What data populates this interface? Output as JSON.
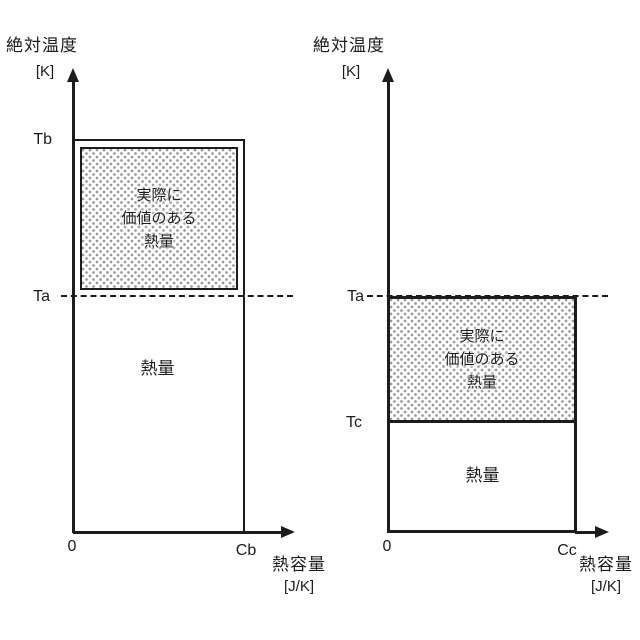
{
  "colors": {
    "line": "#1c1c1c",
    "stipple_dot": "#9a9a9a",
    "background": "#ffffff"
  },
  "panels": [
    {
      "name": "left",
      "y_axis_title": "絶対温度",
      "y_axis_unit": "[K]",
      "x_axis_title": "熱容量",
      "x_axis_unit": "[J/K]",
      "origin": "0",
      "x_max_label": "Cb",
      "y_top_label": "Tb",
      "y_dashed_label": "Ta",
      "valuable_heat": [
        "実際に",
        "価値のある",
        "熱量"
      ],
      "heat_label": "熱量"
    },
    {
      "name": "right",
      "y_axis_title": "絶対温度",
      "y_axis_unit": "[K]",
      "x_axis_title": "熱容量",
      "x_axis_unit": "[J/K]",
      "origin": "0",
      "x_max_label": "Cc",
      "y_dashed_label": "Ta",
      "y_mid_label": "Tc",
      "valuable_heat": [
        "実際に",
        "価値のある",
        "熱量"
      ],
      "heat_label": "熱量"
    }
  ]
}
